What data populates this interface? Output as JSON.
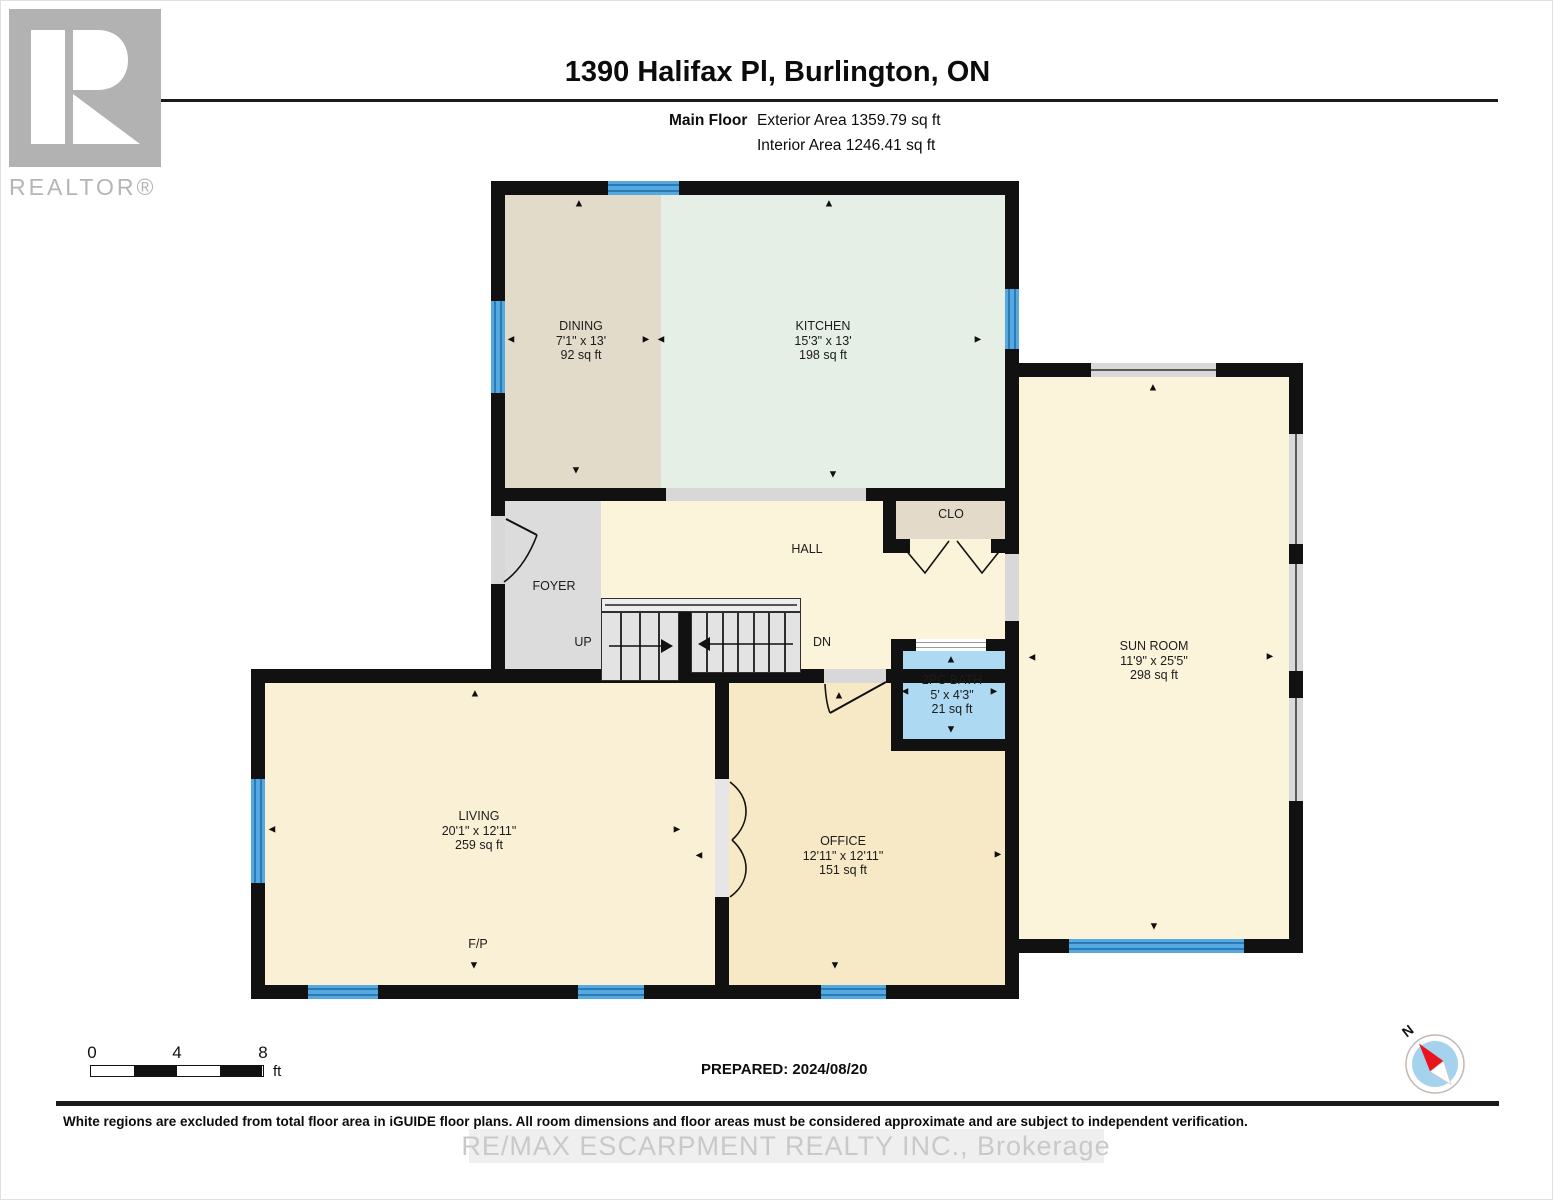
{
  "header": {
    "title": "1390 Halifax Pl, Burlington, ON",
    "floor_label": "Main Floor",
    "exterior_area": "Exterior Area 1359.79 sq ft",
    "interior_area": "Interior Area 1246.41 sq ft"
  },
  "logo": {
    "wordmark": "REALTOR®"
  },
  "floor_plan": {
    "rooms": {
      "dining": {
        "name": "DINING",
        "dims": "7'1\" x 13'",
        "area": "92 sq ft"
      },
      "kitchen": {
        "name": "KITCHEN",
        "dims": "15'3\" x 13'",
        "area": "198 sq ft"
      },
      "sun_room": {
        "name": "SUN ROOM",
        "dims": "11'9\" x 25'5\"",
        "area": "298 sq ft"
      },
      "living": {
        "name": "LIVING",
        "dims": "20'1\" x 12'11\"",
        "area": "259 sq ft"
      },
      "office": {
        "name": "OFFICE",
        "dims": "12'11\" x 12'11\"",
        "area": "151 sq ft"
      },
      "bath": {
        "name": "2PC BATH",
        "dims": "5' x 4'3\"",
        "area": "21 sq ft"
      }
    },
    "annotations": {
      "hall": "HALL",
      "foyer": "FOYER",
      "closet": "CLO",
      "stairs_up": "UP",
      "stairs_down": "DN",
      "fireplace": "F/P"
    }
  },
  "scale_bar": {
    "tick_0": "0",
    "tick_4": "4",
    "tick_8": "8",
    "unit": "ft"
  },
  "footer": {
    "prepared": "PREPARED: 2024/08/20",
    "disclaimer": "White regions are excluded from total floor area in iGUIDE floor plans. All room dimensions and floor areas must be considered approximate and are subject to independent verification.",
    "watermark": "RE/MAX ESCARPMENT REALTY INC., Brokerage",
    "compass_north": "N"
  },
  "colors": {
    "wall": "#111111",
    "window_blue": "#55a9e0",
    "bath_blue": "#aed9f2",
    "dining_tan": "#e3dbca",
    "kitchen_green": "#e5efe6",
    "hall_cream": "#fbf3da",
    "living_cream": "#faf0d6",
    "office_cream": "#f8e9c6",
    "foyer_gray": "#dcdcdc"
  }
}
